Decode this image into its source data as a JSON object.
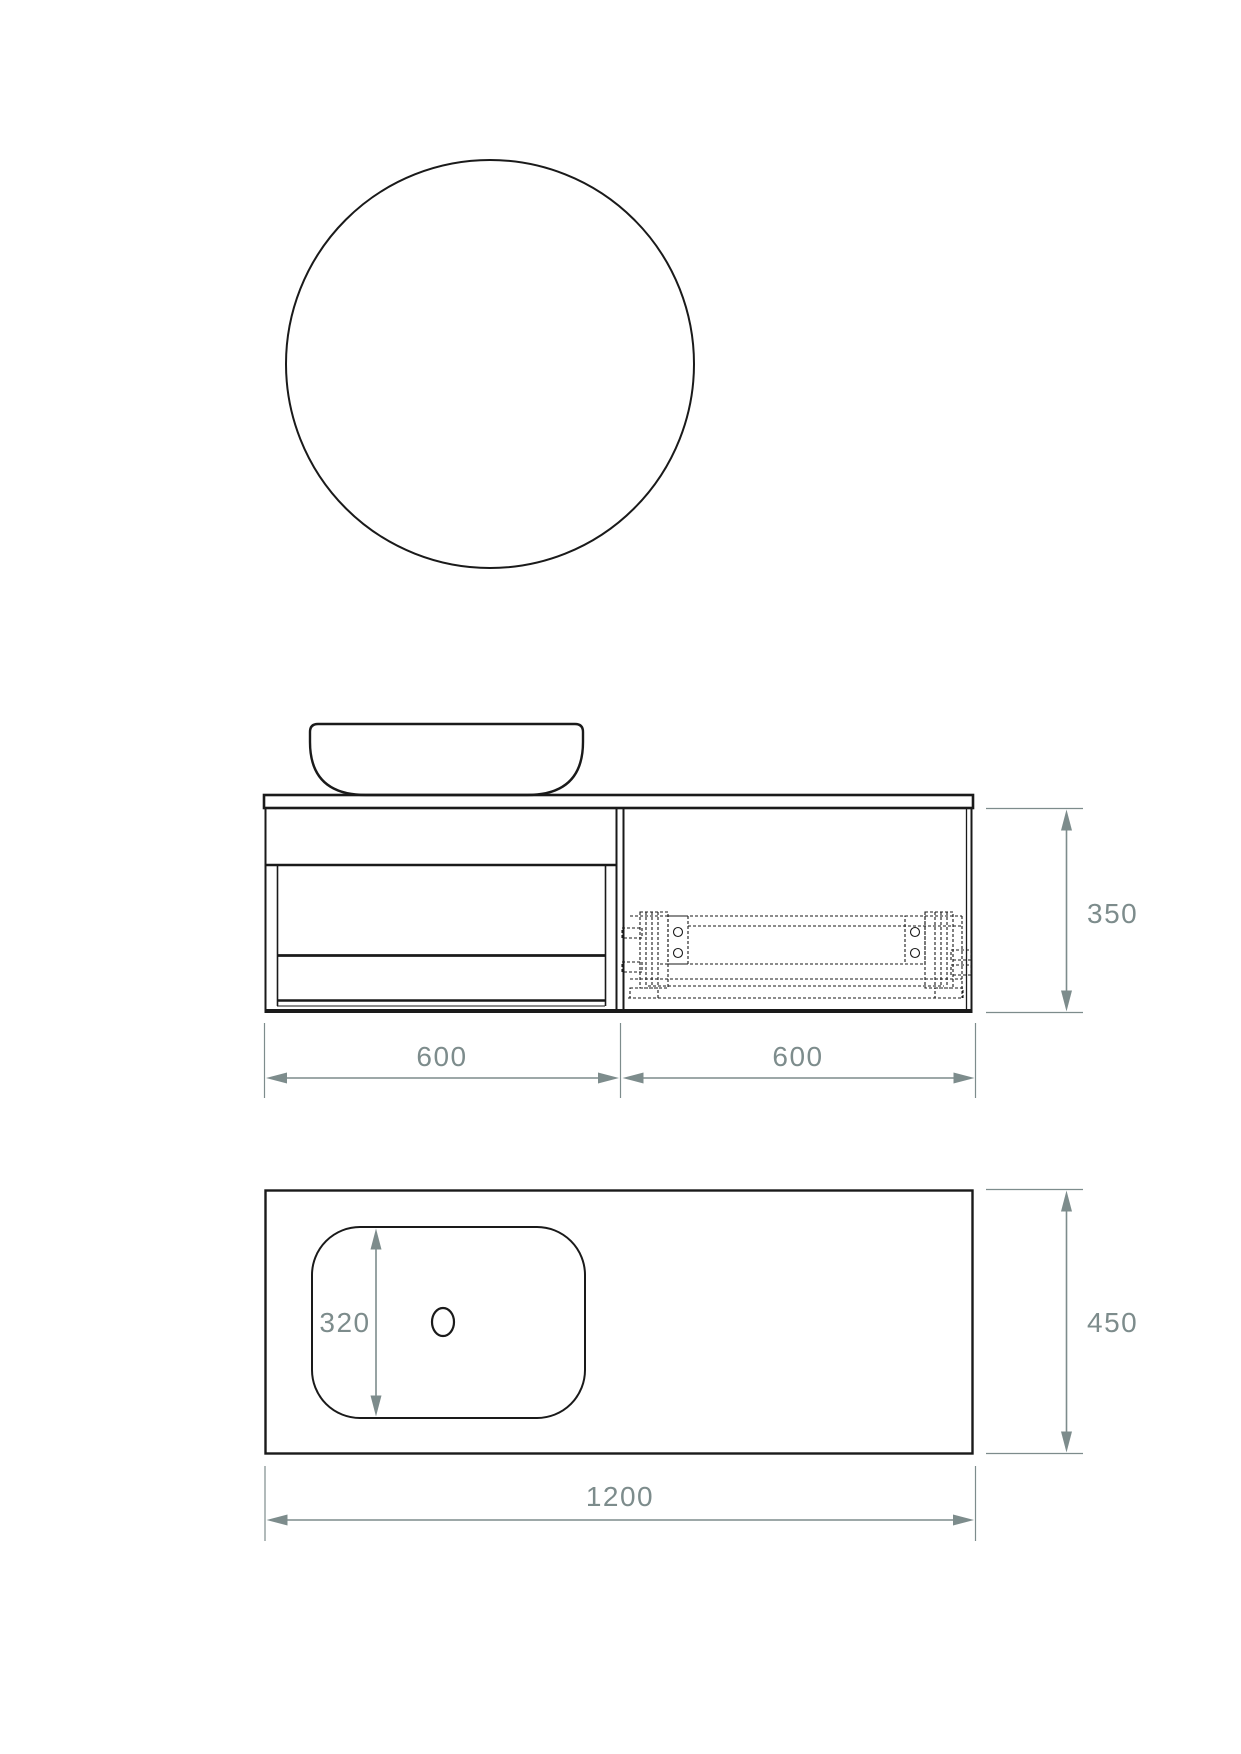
{
  "drawing": {
    "colors": {
      "line_color": "#1a1a1a",
      "dim_color": "#7d8c8c",
      "background": "#ffffff"
    },
    "views": {
      "mirror": "round-mirror-front-view",
      "elevation": "vanity-front-elevation",
      "plan": "countertop-plan-view"
    },
    "dimensions": {
      "left_module_width": "600",
      "right_module_width": "600",
      "cabinet_height": "350",
      "basin_cutout_depth": "320",
      "countertop_depth": "450",
      "countertop_width": "1200"
    }
  }
}
